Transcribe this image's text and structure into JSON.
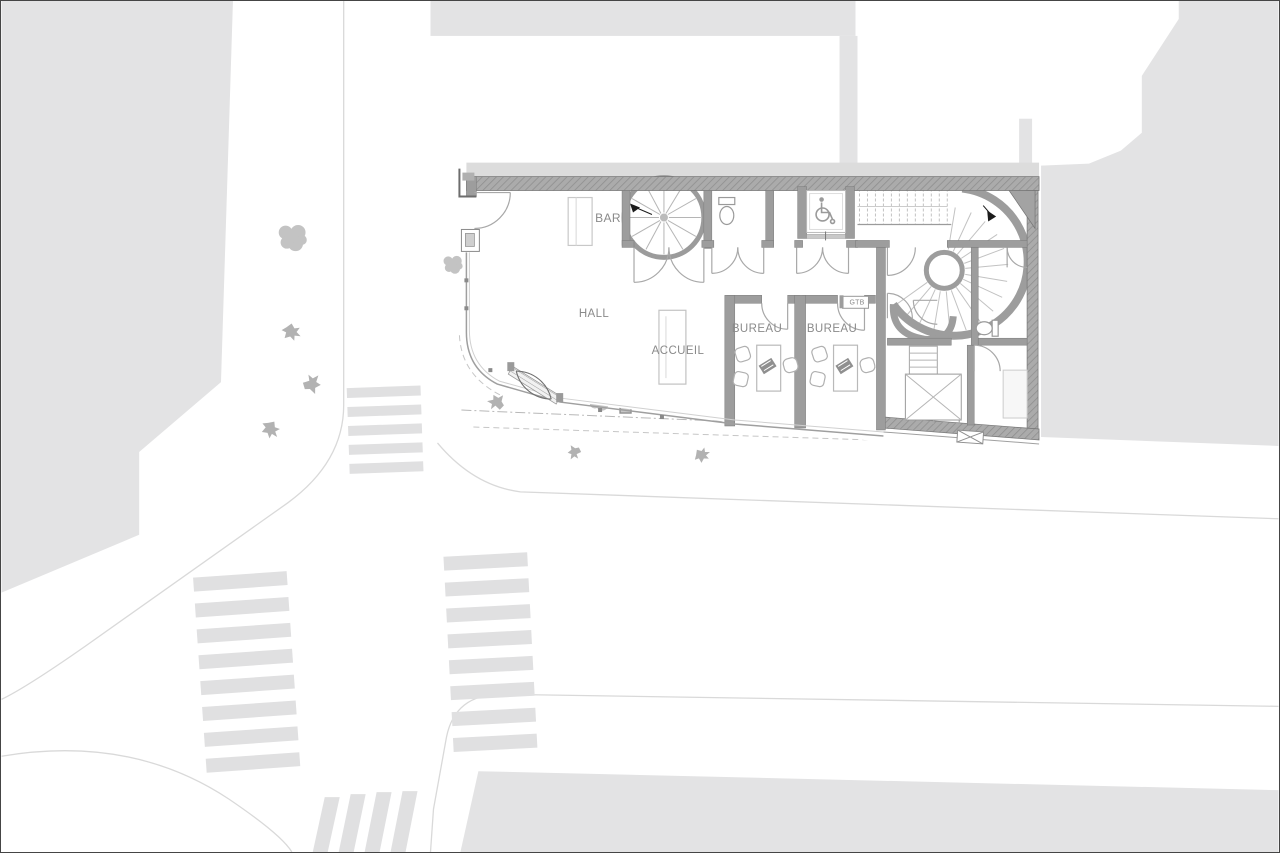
{
  "drawing": {
    "type": "architectural-site-plan-ground-floor",
    "floor_labels": {
      "bar": "BAR",
      "hall": "HALL",
      "accueil": "ACCUEIL",
      "bureau_left": "BUREAU",
      "bureau_right": "BUREAU",
      "gtb": "GTB"
    }
  },
  "palette": {
    "paper": "#ffffff",
    "frame": "#454545",
    "building_mass": "#e3e3e4",
    "street_line": "#d9d9d9",
    "crosswalk_stripe": "#e0e0e1",
    "wall": "#a0a0a0",
    "wall_hatch": "#909090",
    "wall_edge": "#747474",
    "detail_line": "#a8a8a8",
    "furniture_line": "#bdbdbd",
    "silhouette": "#b2b2b2",
    "label_text": "#8a8a8a",
    "stair_arrow": "#1c1c1c"
  },
  "icon_names": [
    "spiral-staircase-icon",
    "curved-staircase-icon",
    "straight-stair-icon",
    "elevator-icon",
    "wheelchair-icon",
    "toilet-icon",
    "door-swing-icon",
    "entrance-door-icon",
    "stair-arrow-icon",
    "shaft-x-icon",
    "cellar-hatch-icon",
    "crosswalk-stripes",
    "tree-icon",
    "person-icon",
    "planter-icon",
    "desk-icon",
    "chair-icon",
    "laptop-icon",
    "bar-counter-icon",
    "reception-desk-icon"
  ]
}
